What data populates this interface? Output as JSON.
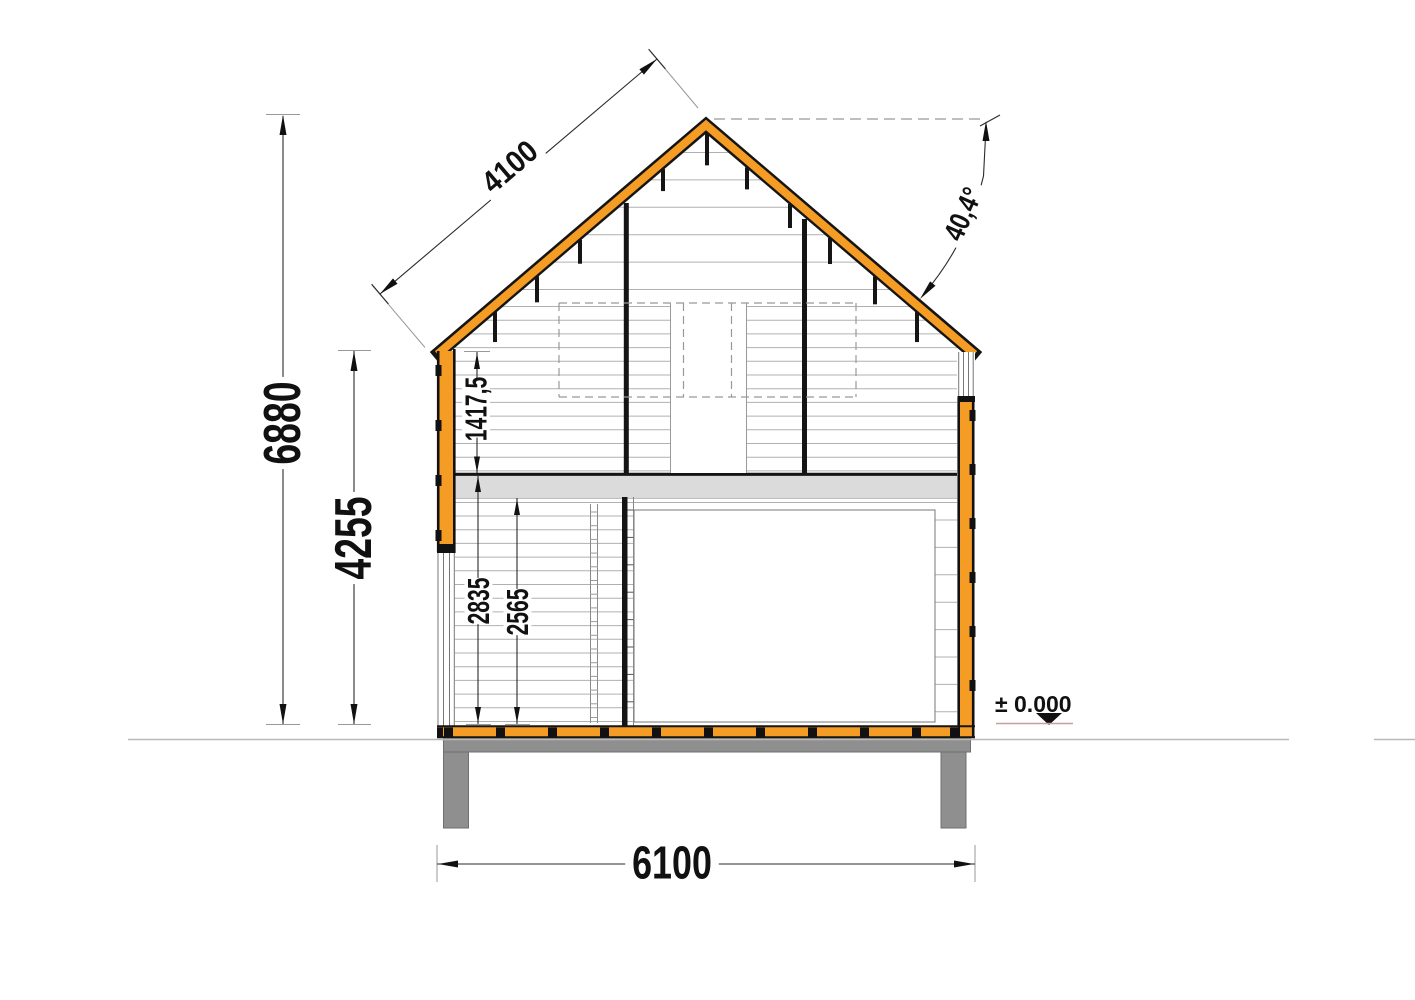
{
  "dimensions": {
    "total_width": "6100",
    "total_height": "6880",
    "wall_height": "4255",
    "roof_slope_length": "4100",
    "roof_angle": "40,4°",
    "loft_wall_to_slab_height": "1417,5",
    "ground_floor_height": "2835",
    "ground_floor_ceiling_height": "2565"
  },
  "level_marker": {
    "label": "± 0.000"
  },
  "colors": {
    "timber_orange": "#F59C25",
    "foundation_gray": "#8F8F8F",
    "slab_gray": "#DBDBDB"
  }
}
